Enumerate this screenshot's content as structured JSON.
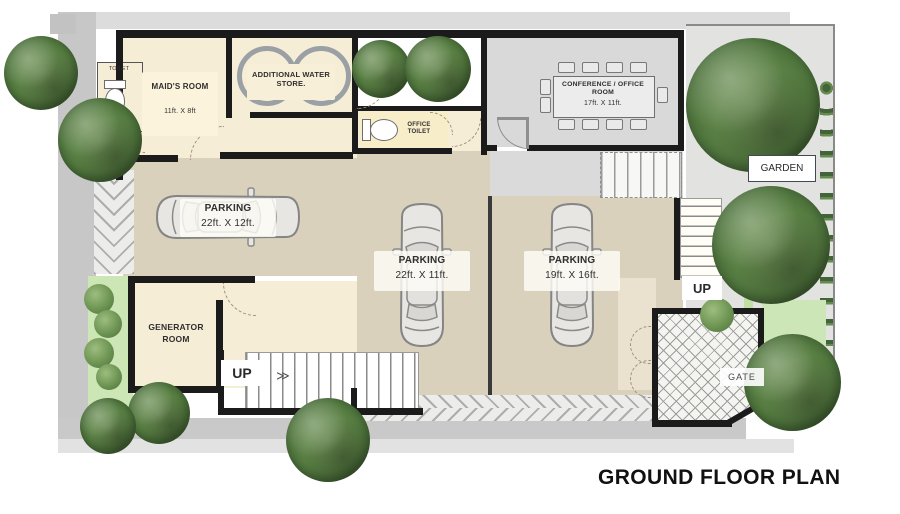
{
  "title": "GROUND FLOOR PLAN",
  "palette": {
    "wall": "#1b1b1b",
    "room_cream": "#f6edd6",
    "office_toilet_cream": "#f8edc9",
    "parking_tan": "#d9d1bc",
    "floor_gray": "#d9d9d9",
    "garden_gray": "#e2e2e0",
    "planter_green": "#cde6b5",
    "tree_green": "#4c7038"
  },
  "rooms": {
    "toilet": {
      "label": "TOILET"
    },
    "maids_room": {
      "label": "MAID'S ROOM",
      "size": "11ft. X 8ft"
    },
    "water_store": {
      "label": "ADDITIONAL WATER STORE."
    },
    "office_toilet": {
      "label": "OFFICE TOILET"
    },
    "conference_room": {
      "label": "CONFERENCE / OFFICE ROOM",
      "size": "17ft. X 11ft."
    },
    "garden": {
      "label": "GARDEN"
    },
    "generator_room": {
      "line1": "GENERATOR",
      "line2": "ROOM"
    },
    "parking_1": {
      "label": "PARKING",
      "size": "22ft. X 12ft."
    },
    "parking_2": {
      "label": "PARKING",
      "size": "22ft. X 11ft."
    },
    "parking_3": {
      "label": "PARKING",
      "size": "19ft. X 16ft."
    }
  },
  "markers": {
    "up_left": "UP",
    "up_right": "UP",
    "gate": "GATE"
  },
  "stair_arrow": "≫"
}
